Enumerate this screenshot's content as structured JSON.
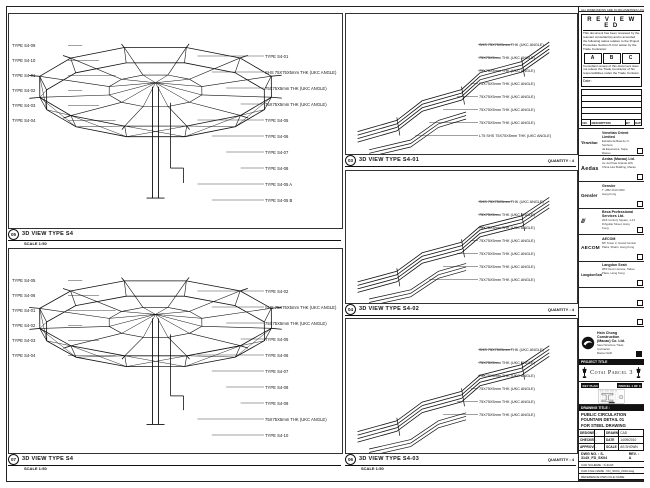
{
  "colors": {
    "line": "#111111",
    "paper": "#ffffff"
  },
  "panels": {
    "left_top": {
      "num": "05",
      "title": "3D VIEW TYPE S4",
      "scale": "SCALE 1:50",
      "left_labels": [
        "TYPE S4-09",
        "TYPE S4-10",
        "TYPE S4-01",
        "TYPE S4-02",
        "TYPE S4-03",
        "TYPE S4-04"
      ],
      "right_labels": [
        "TYPE S4-01",
        "SHS 75X75X5mm THK (UKC ANGLE)",
        "75X75X5mm THK (UKC ANGLE)",
        "75X75X5mm THK (UKC ANGLE)",
        "TYPE S4-05",
        "TYPE S4-06",
        "TYPE S4-07",
        "TYPE S4-08",
        "TYPE S4-05 A",
        "TYPE S4-05 B"
      ]
    },
    "left_bottom": {
      "num": "07",
      "title": "3D VIEW TYPE S4",
      "scale": "SCALE 1:50",
      "left_labels": [
        "TYPE S4-05",
        "TYPE S4-06",
        "TYPE S4-01",
        "TYPE S4-02",
        "TYPE S4-03",
        "TYPE S4-04"
      ],
      "right_labels": [
        "TYPE S4-02",
        "SHS 75X75X5mm THK (UKC ANGLE)",
        "75X75X5mm THK (UKC ANGLE)",
        "TYPE S4-05",
        "TYPE S4-06",
        "TYPE S4-07",
        "TYPE S4-08",
        "TYPE S4-09",
        "75X75X5mm THK (UKC ANGLE)",
        "TYPE S4-10"
      ]
    },
    "mid_top": {
      "num": "03",
      "title": "3D VIEW TYPE S4-01",
      "quantity": "QUANTITY : 4",
      "labels": [
        "SHS 75X75X5mm THK (UKC ANGLE)",
        "75X75X5mm THK (UKC ANGLE)",
        "75X75X5mm THK (UKC ANGLE)",
        "75X75X5mm THK (UKC ANGLE)",
        "75X75X5mm THK (UKC ANGLE)",
        "75X75X5mm THK (UKC ANGLE)",
        "75X75X5mm THK (UKC ANGLE)",
        "L75 SHS 75X75X5mm THK (UKC ANGLE)"
      ]
    },
    "mid_mid": {
      "num": "04",
      "title": "3D VIEW TYPE S4-02",
      "quantity": "QUANTITY : 4",
      "labels": [
        "SHS 75X75X5mm THK (UKC ANGLE)",
        "75X75X5mm THK (UKC ANGLE)",
        "75X75X5mm THK (UKC ANGLE)",
        "75X75X5mm THK (UKC ANGLE)",
        "75X75X5mm THK (UKC ANGLE)",
        "75X75X5mm THK (UKC ANGLE)",
        "75X75X5mm THK (UKC ANGLE)"
      ]
    },
    "mid_bot": {
      "num": "06",
      "title": "3D VIEW TYPE S4-03",
      "quantity": "QUANTITY : 4",
      "scale": "SCALE 1:50",
      "labels": [
        "SHS 75X75X5mm THK (UKC ANGLE)",
        "75X75X5mm THK (UKC ANGLE)",
        "75X75X5mm THK (UKC ANGLE)",
        "75X75X5mm THK (UKC ANGLE)",
        "75X75X5mm THK (UKC ANGLE)",
        "75X75X5mm THK (UKC ANGLE)"
      ]
    }
  },
  "titleblock": {
    "top_note": "ALL DIMENSIONS ARE IN MILLIMETRES UNLESS OTHERWISE NOTED",
    "reviewed": {
      "title": "R E V I E W E D",
      "body1": "This document has been reviewed by the relevant consultant(s) and is accorded the following status relative to the Project Procedure Section 5.4 for action by the Trade Contractor.",
      "options": [
        "A",
        "B",
        "C"
      ],
      "body2": "Consultant review of this document does not relieve the Trade Contractor of his responsibilities under the Trade Contract.",
      "date_label": "Date :"
    },
    "revisions": {
      "header": [
        "NO.",
        "DESCRIPTION",
        "BY",
        "DATE"
      ]
    },
    "consultants": [
      {
        "logo": "Venetian",
        "name": "Venetian Orient Limited",
        "line1": "Estrada da Baia de N. Senhora",
        "line2": "da Esperanca, Taipa, Macau"
      },
      {
        "logo": "Aedas",
        "name": "Aedas (Macau) Ltd.",
        "line1": "Av. da Praia Grande 409,",
        "line2": "China Law Building, Macau"
      },
      {
        "logo": "Gensler",
        "name": "Gensler",
        "line1": "T +852 2110 2000",
        "line2": "Hong Kong"
      },
      {
        "logo": "///",
        "name": "Beca Professional Services Ltd.",
        "line1": "20/F Century Square, 1-13",
        "line2": "D'Aguilar Street, Hong Kong"
      },
      {
        "logo": "AECOM",
        "name": "AECOM",
        "line1": "8/F Tower 2, Grand Central",
        "line2": "Plaza, Shatin, Hong Kong"
      },
      {
        "logo": "LangdonSeah",
        "name": "Langdon Seah",
        "line1": "28/F Devon House, Taikoo",
        "line2": "Place, Hong Kong"
      }
    ],
    "contractor": {
      "name": "Hsin Chong Construction (Macau) Co. Ltd.",
      "line1": "Steel Structure Trade Contractor",
      "line2": "Macau SAR"
    },
    "project": {
      "header": "PROJECT TITLE",
      "name": "Cotai Parcel 3"
    },
    "keyplan": {
      "label": "KEY PLAN",
      "parcel": "PARCEL 1 OF 3"
    },
    "drawing": {
      "header": "DRAWING TITLE :",
      "line1": "PUBLIC CIRCULATION",
      "line2": "FOUNTAIN DETAIL 01",
      "line3": "FOR STEEL DRAWING",
      "fields": [
        {
          "a": "DESIGNED",
          "b": "-",
          "c": "DRAWN",
          "d": "CAD"
        },
        {
          "a": "CHECKED",
          "b": "-",
          "c": "DATE",
          "d": "14/09/2010"
        },
        {
          "a": "APPROVED",
          "b": "-",
          "c": "SCALE",
          "d": "AS SHOWN"
        }
      ],
      "dwg_label": "DWG NO. : S-314X_FD_SK04",
      "rev": "REV. : A",
      "cad_lines": [
        "CAD SCHEME : S-314X",
        "CAD FILE NAME : FD_SK04_2010.dwg",
        "REFERENCE DWG FILE NAME"
      ]
    }
  }
}
